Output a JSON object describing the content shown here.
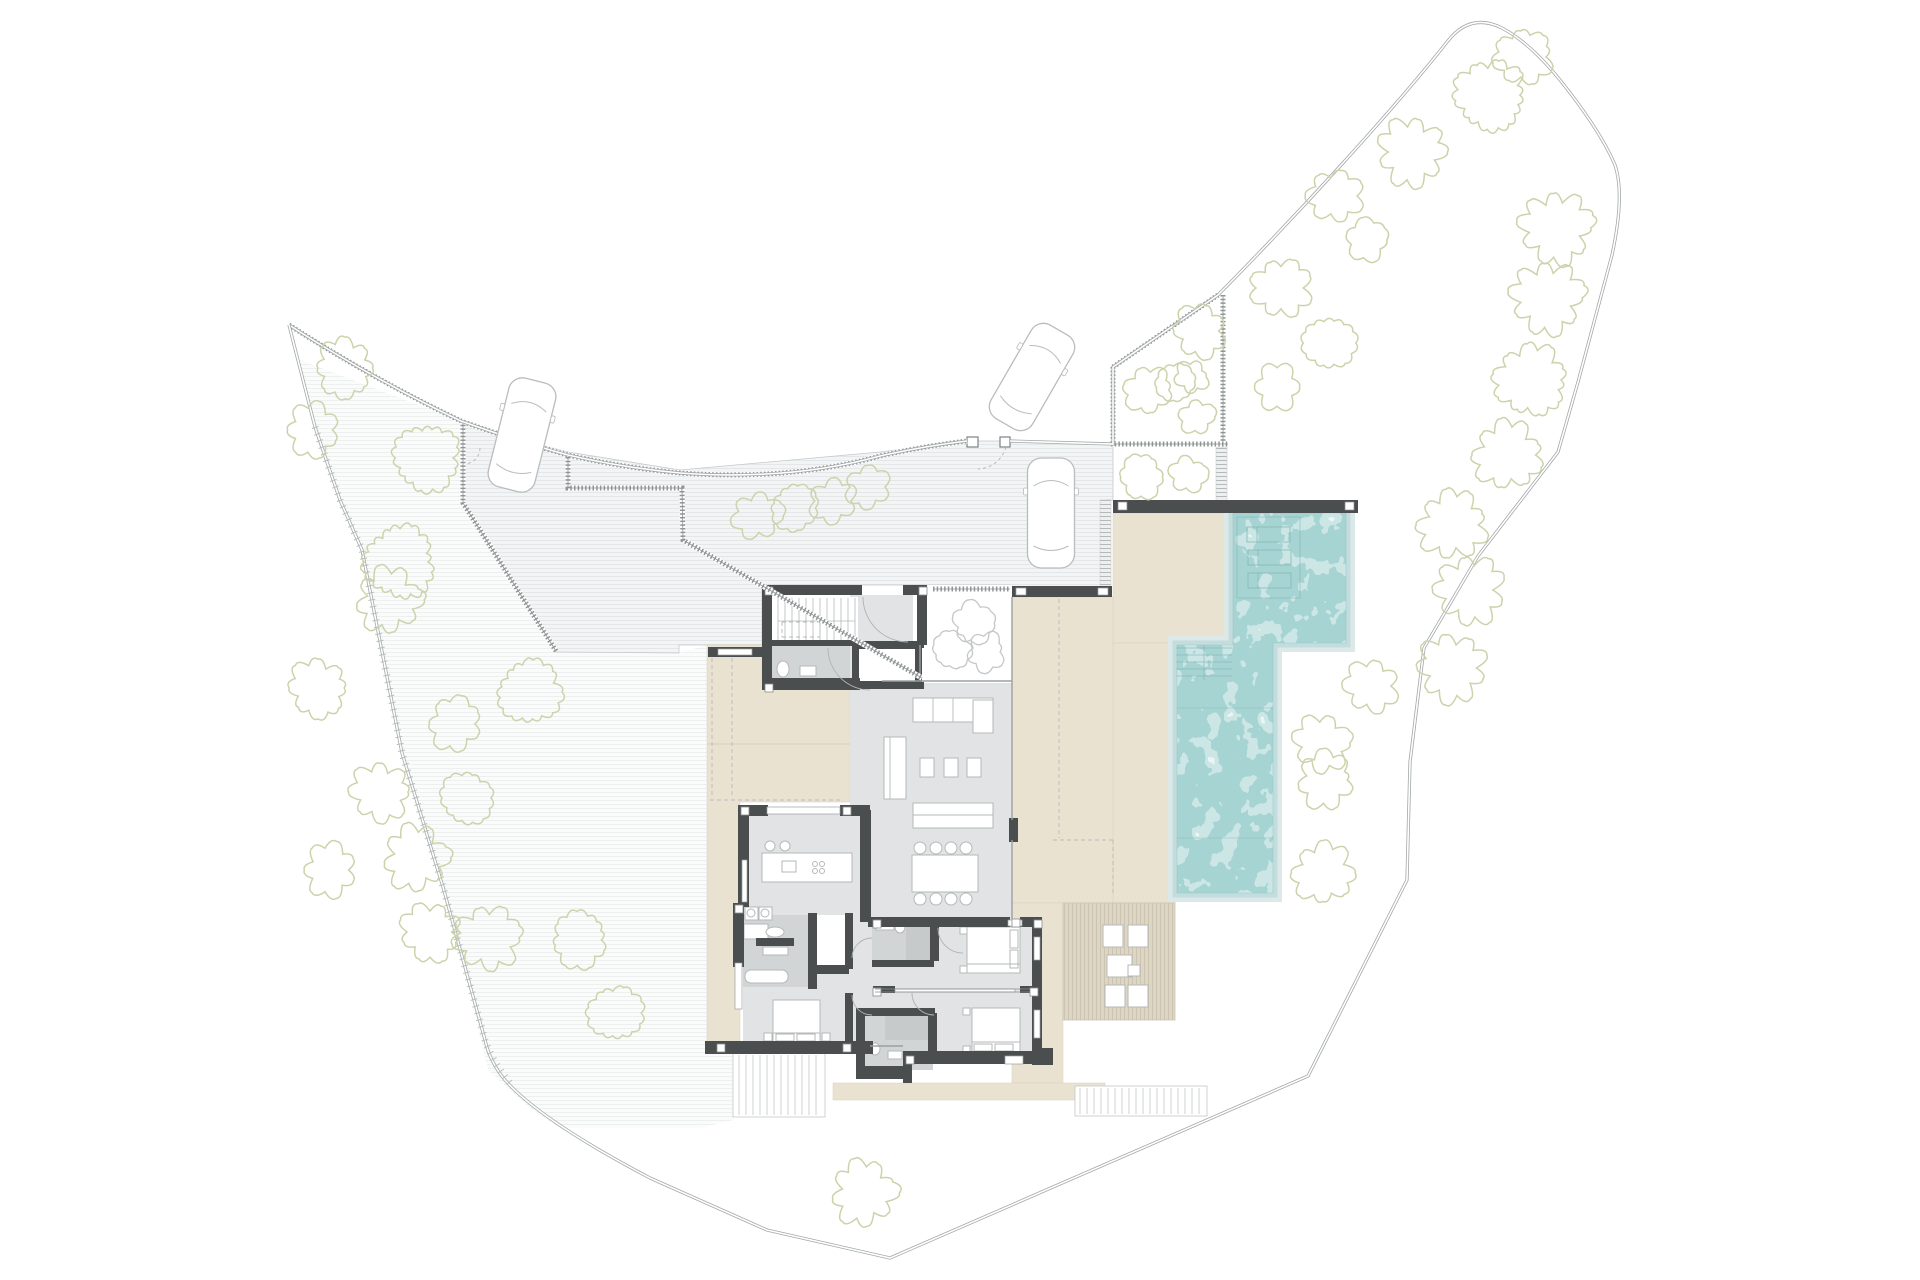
{
  "canvas": {
    "w": 1920,
    "h": 1280,
    "bg": "#ffffff"
  },
  "colors": {
    "boundary": "#a3a8a8",
    "boundaryInner": "#ffffff",
    "hatch": "#8f9494",
    "tick": "#b9bdbd",
    "court": "#f3f4f5",
    "courtLine": "#e4e7e7",
    "slope": "#fafbfb",
    "slopeLine": "#eef0f0",
    "beige": "#eae2d1",
    "beigeEdge": "#d8cfbc",
    "deck": "#ded6c5",
    "deckLine": "#ccc4b1",
    "wall": "#4b4e4f",
    "floor": "#e1e3e4",
    "bath": "#d2d5d6",
    "shower": "#c6caca",
    "white": "#ffffff",
    "poolBase": "#a6d4d3",
    "poolHalo1": "#c2dddd",
    "poolHalo2": "#dde8e8",
    "poolDetail": "#85b4b4",
    "furn": "#b5b9b9",
    "furnFill": "#ffffff",
    "treeGreen": "#ccd3ab",
    "treeGray": "#c3c8c6",
    "thin": "#c5c9c9",
    "dash": "#b7bbbb",
    "arc": "#b0b4b4",
    "glass": "#9aa0a0",
    "carStroke": "#b9bdbd",
    "stepStrip": "#b5b9b9",
    "stair": "#c3c7c7"
  },
  "boundary": {
    "fence_path": "M289,325 Q375,380 461,421 Q520,442 568,455 Q625,468 680,473 Q790,481 880,456 Q925,446 967,441",
    "main_path": "M1010,441 L1113,444 L1113,367 L1218,295 C1300,212 1395,108 1447,42 Q1470,12 1502,28 Q1530,43 1560,80 Q1600,130 1615,165 Q1625,195 1612,255 L1578,382 L1558,452 L1478,556 L1424,648 L1410,762 L1407,880 L1308,1076 L890,1258 L767,1230 L650,1178 Q540,1120 505,1080 Q490,1062 485,1040 L443,887 L402,753 L362,550 L340,500 L315,427 L289,325",
    "left_ticks": "M315,427 L340,500 L362,550 L402,753 L443,887 L485,1040 Q493,1063 510,1083"
  },
  "ground": {
    "slope_poly": "300,360 315,427 340,500 362,550 402,753 443,887 468,980 488,1070 530,1108 560,1128 700,1128 733,1120 733,1045 707,1045 707,645 679,653 556,652 465,505 461,421",
    "court_poly": "465,425 568,452 680,470 880,452 967,441 1010,441 1113,445 1113,500 1105,500 1105,590 1010,590 1010,585 933,585 762,585 762,645 679,645 679,653 556,652 465,505"
  },
  "terraces": [
    "707,645 762,645 762,680 850,680 850,802 740,802 740,1045 707,1045",
    "1113,513 1233,513 1233,643 1113,643",
    "1113,643 1175,643 1175,903 1113,903",
    "1012,597 1113,597 1113,903 1012,903",
    "1012,903 1063,903 1063,1083 1012,1083",
    "833,1083 1105,1083 1105,1100 833,1100"
  ],
  "deck": {
    "rect": [
      1063,
      903,
      112,
      117
    ],
    "furniture": [
      [
        1103,
        925,
        20,
        22
      ],
      [
        1128,
        925,
        20,
        22
      ],
      [
        1105,
        985,
        20,
        22
      ],
      [
        1128,
        985,
        20,
        22
      ],
      [
        1107,
        955,
        25,
        22
      ],
      [
        1128,
        965,
        12,
        11
      ]
    ]
  },
  "pool": {
    "water_path": "M1233,513 L1346,513 L1346,643 L1273,643 L1273,893 L1177,893 L1177,645 L1233,645 Z",
    "bar": [
      1113,
      500,
      245,
      13
    ],
    "bar_posts": [
      [
        1118,
        502,
        9,
        8
      ],
      [
        1345,
        502,
        9,
        8
      ]
    ],
    "lounger_box": [
      1237,
      517,
      63,
      81
    ],
    "loungers": [
      [
        1247,
        527,
        43,
        15
      ],
      [
        1248,
        550,
        43,
        15
      ],
      [
        1248,
        573,
        43,
        15
      ]
    ],
    "steps": {
      "y0": 648,
      "y1": 678,
      "step": 7,
      "x0": 1176,
      "x1": 1232,
      "divider": [
        1204,
        645,
        1204,
        680
      ]
    },
    "section_lines": [
      [
        1177,
        708,
        1273,
        708
      ],
      [
        1177,
        838,
        1273,
        838
      ]
    ]
  },
  "step_strips": [
    [
      1100,
      500,
      11,
      88
    ],
    [
      1216,
      447,
      11,
      55
    ]
  ],
  "hatch_walls": [
    "M289,325 Q375,380 461,421 Q520,442 568,455 Q625,468 680,473 Q790,481 880,456 Q925,446 967,441",
    "M463,421 L463,503 L556,651",
    "M568,457 L568,488 L682,488 L683,540 L922,678",
    "M933,589 L1010,589",
    "M1223,295 L1223,447",
    "M1111,444 L1228,444",
    "M1113,367 L1218,295",
    "M1113,367 L1113,443"
  ],
  "gate_posts": [
    [
      967,
      437,
      11,
      10
    ],
    [
      1000,
      437,
      10,
      10
    ]
  ],
  "floors": [
    [
      850,
      595,
      63,
      88,
      "floor"
    ],
    [
      768,
      597,
      90,
      48,
      "white"
    ],
    [
      768,
      645,
      82,
      38,
      "bath"
    ],
    [
      850,
      683,
      162,
      237,
      "floor"
    ],
    [
      748,
      807,
      114,
      96,
      "floor"
    ],
    [
      743,
      903,
      129,
      145,
      "floor"
    ],
    [
      743,
      915,
      65,
      72,
      "bath"
    ],
    [
      817,
      915,
      30,
      52,
      "white"
    ],
    [
      872,
      919,
      170,
      140,
      "floor"
    ],
    [
      872,
      920,
      61,
      47,
      "bath"
    ],
    [
      906,
      923,
      26,
      42,
      "shower"
    ],
    [
      858,
      1010,
      75,
      60,
      "bath"
    ],
    [
      885,
      1015,
      44,
      25,
      "shower"
    ],
    [
      920,
      585,
      92,
      96,
      "white"
    ],
    [
      852,
      643,
      70,
      44,
      "wall"
    ],
    [
      858,
      649,
      58,
      32,
      "white"
    ]
  ],
  "walls": [
    [
      762,
      585,
      100,
      10
    ],
    [
      903,
      585,
      24,
      10
    ],
    [
      762,
      585,
      10,
      105
    ],
    [
      917,
      585,
      10,
      60
    ],
    [
      762,
      678,
      98,
      12
    ],
    [
      768,
      640,
      84,
      6
    ],
    [
      852,
      641,
      72,
      7
    ],
    [
      852,
      682,
      72,
      7
    ],
    [
      852,
      641,
      7,
      48
    ],
    [
      915,
      641,
      7,
      48
    ],
    [
      708,
      647,
      56,
      10
    ],
    [
      1012,
      586,
      100,
      11
    ],
    [
      1009,
      818,
      9,
      24
    ],
    [
      740,
      805,
      28,
      11
    ],
    [
      840,
      805,
      30,
      11
    ],
    [
      860,
      810,
      11,
      112
    ],
    [
      738,
      805,
      11,
      102
    ],
    [
      733,
      903,
      11,
      64
    ],
    [
      705,
      1041,
      168,
      13
    ],
    [
      868,
      917,
      142,
      10
    ],
    [
      1020,
      917,
      22,
      10
    ],
    [
      1032,
      917,
      10,
      77
    ],
    [
      1032,
      991,
      10,
      64
    ],
    [
      873,
      986,
      22,
      7
    ],
    [
      1020,
      986,
      22,
      7
    ],
    [
      930,
      919,
      9,
      42
    ],
    [
      872,
      960,
      62,
      7
    ],
    [
      928,
      1013,
      9,
      42
    ],
    [
      858,
      1008,
      77,
      8
    ],
    [
      856,
      1008,
      9,
      62
    ],
    [
      856,
      1066,
      49,
      13
    ],
    [
      903,
      1051,
      9,
      32
    ],
    [
      903,
      1051,
      141,
      13
    ],
    [
      1032,
      1048,
      21,
      17
    ],
    [
      808,
      913,
      9,
      76
    ],
    [
      756,
      938,
      38,
      8
    ],
    [
      810,
      965,
      39,
      9
    ],
    [
      845,
      913,
      8,
      56
    ],
    [
      845,
      993,
      8,
      50
    ],
    [
      1113,
      500,
      245,
      13
    ]
  ],
  "window_insets": [
    [
      718,
      649,
      34,
      6
    ],
    [
      1016,
      588,
      10,
      7
    ],
    [
      1098,
      588,
      10,
      7
    ],
    [
      767,
      807,
      73,
      7
    ],
    [
      742,
      860,
      5,
      42
    ],
    [
      735,
      963,
      7,
      46
    ],
    [
      1034,
      937,
      6,
      23
    ],
    [
      1034,
      1010,
      6,
      28
    ],
    [
      1008,
      920,
      14,
      6
    ],
    [
      1005,
      1056,
      18,
      8
    ],
    [
      895,
      989,
      120,
      3
    ]
  ],
  "posts": [
    [
      765,
      587
    ],
    [
      919,
      587
    ],
    [
      765,
      684
    ],
    [
      873,
      920
    ],
    [
      1034,
      920
    ],
    [
      717,
      1044
    ],
    [
      843,
      1044
    ],
    [
      906,
      1056
    ],
    [
      735,
      905
    ],
    [
      843,
      807
    ],
    [
      741,
      807
    ],
    [
      873,
      988
    ],
    [
      1030,
      988
    ],
    [
      1012,
      919
    ]
  ],
  "glass_lines": [
    [
      882,
      681,
      1012,
      681
    ],
    [
      1012,
      597,
      1012,
      820
    ],
    [
      1012,
      840,
      1012,
      919
    ],
    [
      920,
      645,
      920,
      680
    ],
    [
      870,
      1046,
      903,
      1046
    ]
  ],
  "thin_lines": [
    [
      707,
      744,
      850,
      744
    ]
  ],
  "dashed_lines": [
    [
      712,
      658,
      712,
      798
    ],
    [
      732,
      658,
      732,
      798
    ],
    [
      710,
      800,
      843,
      800
    ],
    [
      1059,
      599,
      1059,
      838
    ],
    [
      1053,
      840,
      1113,
      840
    ],
    [
      1113,
      840,
      1113,
      893
    ],
    [
      782,
      622,
      820,
      622
    ],
    [
      782,
      637,
      820,
      637
    ],
    [
      782,
      622,
      782,
      637
    ],
    [
      820,
      622,
      820,
      637
    ]
  ],
  "pocket_door": [
    [
      875,
      989,
      1030,
      989
    ],
    [
      875,
      992,
      1030,
      992
    ]
  ],
  "arcs": [
    {
      "d": "M863,597 A45,45 0 0 0 908,642",
      "dash": false
    },
    {
      "d": "M828,648 A42,42 0 0 0 870,690",
      "dash": false
    },
    {
      "d": "M872,938 A20,20 0 0 0 852,958",
      "dash": false
    },
    {
      "d": "M872,1015 A20,20 0 0 1 852,995",
      "dash": false
    },
    {
      "d": "M938,928 A25,25 0 0 0 963,953",
      "dash": false
    },
    {
      "d": "M912,993 A22,22 0 0 0 934,1015",
      "dash": false
    },
    {
      "d": "M1006,447 A30,30 0 0 1 978,469",
      "dash": true
    },
    {
      "d": "M480,448 A16,16 0 0 1 464,464",
      "dash": true
    }
  ],
  "stairs": {
    "entry": {
      "x0": 778,
      "x1": 855,
      "step": 7,
      "y0": 598,
      "y1": 644
    },
    "ext1": {
      "box": [
        733,
        1053,
        92,
        64
      ],
      "x0": 739,
      "x1": 819,
      "step": 7,
      "y0": 1055,
      "y1": 1115
    },
    "ext2": {
      "box": [
        1075,
        1086,
        132,
        30
      ],
      "x0": 1080,
      "x1": 1202,
      "step": 7,
      "y0": 1088,
      "y1": 1114
    }
  },
  "furniture": {
    "rects": [
      [
        913,
        698,
        80,
        24
      ],
      [
        973,
        700,
        20,
        33
      ],
      [
        884,
        737,
        22,
        62
      ],
      [
        920,
        758,
        14,
        19
      ],
      [
        944,
        758,
        14,
        19
      ],
      [
        967,
        758,
        14,
        19
      ],
      [
        913,
        803,
        80,
        25
      ],
      [
        912,
        855,
        66,
        37
      ],
      [
        762,
        853,
        90,
        29
      ],
      [
        782,
        861,
        14,
        11
      ],
      [
        745,
        907,
        13,
        13
      ],
      [
        759,
        907,
        13,
        13
      ],
      [
        800,
        666,
        16,
        10
      ],
      [
        744,
        924,
        24,
        15
      ],
      [
        763,
        947,
        25,
        8
      ],
      [
        773,
        1000,
        47,
        43
      ],
      [
        776,
        1034,
        18,
        7
      ],
      [
        797,
        1034,
        18,
        7
      ],
      [
        764,
        1033,
        8,
        8
      ],
      [
        822,
        1033,
        8,
        8
      ],
      [
        967,
        927,
        53,
        46
      ],
      [
        1010,
        930,
        8,
        18
      ],
      [
        1010,
        950,
        8,
        18
      ],
      [
        960,
        927,
        7,
        7
      ],
      [
        960,
        966,
        7,
        7
      ],
      [
        972,
        1008,
        48,
        45
      ],
      [
        974,
        1044,
        18,
        7
      ],
      [
        995,
        1044,
        18,
        7
      ],
      [
        963,
        1008,
        7,
        7
      ],
      [
        963,
        1046,
        7,
        7
      ],
      [
        876,
        922,
        18,
        8
      ],
      [
        888,
        1051,
        14,
        8
      ]
    ],
    "round_rects": [
      [
        745,
        970,
        43,
        13
      ]
    ],
    "circles": [
      [
        920,
        848,
        6
      ],
      [
        936,
        848,
        6
      ],
      [
        951,
        848,
        6
      ],
      [
        966,
        848,
        6
      ],
      [
        920,
        899,
        6
      ],
      [
        936,
        899,
        6
      ],
      [
        951,
        899,
        6
      ],
      [
        966,
        899,
        6
      ],
      [
        770,
        846,
        5
      ],
      [
        785,
        846,
        5
      ],
      [
        815,
        864,
        2.5
      ],
      [
        822,
        864,
        2.5
      ],
      [
        815,
        871,
        2.5
      ],
      [
        822,
        871,
        2.5
      ],
      [
        751,
        913,
        4
      ],
      [
        765,
        913,
        4
      ]
    ],
    "ellipses": [
      [
        783,
        669,
        6,
        8
      ],
      [
        775,
        932,
        9,
        5
      ],
      [
        900,
        927,
        5,
        6
      ],
      [
        875,
        1049,
        5,
        6
      ]
    ],
    "lines": [
      [
        933,
        698,
        933,
        722
      ],
      [
        953,
        698,
        953,
        722
      ],
      [
        913,
        815,
        993,
        815
      ],
      [
        890,
        737,
        890,
        799
      ],
      [
        773,
        1033,
        820,
        1033
      ],
      [
        967,
        964,
        1020,
        964
      ],
      [
        972,
        1042,
        1020,
        1042
      ]
    ]
  },
  "courtyard_trees": [
    [
      973,
      623,
      24
    ],
    [
      952,
      650,
      22
    ],
    [
      986,
      652,
      22
    ]
  ],
  "trees": [
    [
      345,
      368,
      33
    ],
    [
      313,
      430,
      30
    ],
    [
      427,
      458,
      38
    ],
    [
      400,
      562,
      41
    ],
    [
      530,
      692,
      36
    ],
    [
      389,
      600,
      36
    ],
    [
      318,
      688,
      33
    ],
    [
      455,
      724,
      30
    ],
    [
      380,
      792,
      33
    ],
    [
      467,
      798,
      30
    ],
    [
      416,
      858,
      36
    ],
    [
      330,
      870,
      30
    ],
    [
      430,
      932,
      33
    ],
    [
      487,
      938,
      36
    ],
    [
      580,
      940,
      32
    ],
    [
      615,
      1013,
      31
    ],
    [
      757,
      516,
      27
    ],
    [
      795,
      508,
      27
    ],
    [
      833,
      501,
      26
    ],
    [
      868,
      487,
      25
    ],
    [
      864,
      1193,
      36
    ],
    [
      1412,
      152,
      38
    ],
    [
      1490,
      95,
      40
    ],
    [
      1523,
      57,
      32
    ],
    [
      1556,
      228,
      40
    ],
    [
      1547,
      298,
      40
    ],
    [
      1530,
      380,
      40
    ],
    [
      1507,
      455,
      38
    ],
    [
      1452,
      525,
      38
    ],
    [
      1366,
      240,
      24
    ],
    [
      1335,
      196,
      30
    ],
    [
      1281,
      288,
      33
    ],
    [
      1329,
      343,
      30
    ],
    [
      1277,
      387,
      26
    ],
    [
      1200,
      331,
      30
    ],
    [
      1176,
      382,
      23
    ],
    [
      1470,
      590,
      38
    ],
    [
      1452,
      668,
      38
    ],
    [
      1371,
      686,
      30
    ],
    [
      1322,
      743,
      32
    ],
    [
      1326,
      780,
      32
    ],
    [
      1323,
      873,
      34
    ],
    [
      1148,
      390,
      27
    ],
    [
      1192,
      377,
      19
    ],
    [
      1197,
      417,
      20
    ],
    [
      1141,
      477,
      25
    ],
    [
      1188,
      475,
      21
    ]
  ],
  "cars": [
    [
      522,
      435,
      48,
      112,
      14
    ],
    [
      1032,
      377,
      48,
      108,
      30
    ],
    [
      1051,
      513,
      47,
      110,
      0
    ]
  ]
}
